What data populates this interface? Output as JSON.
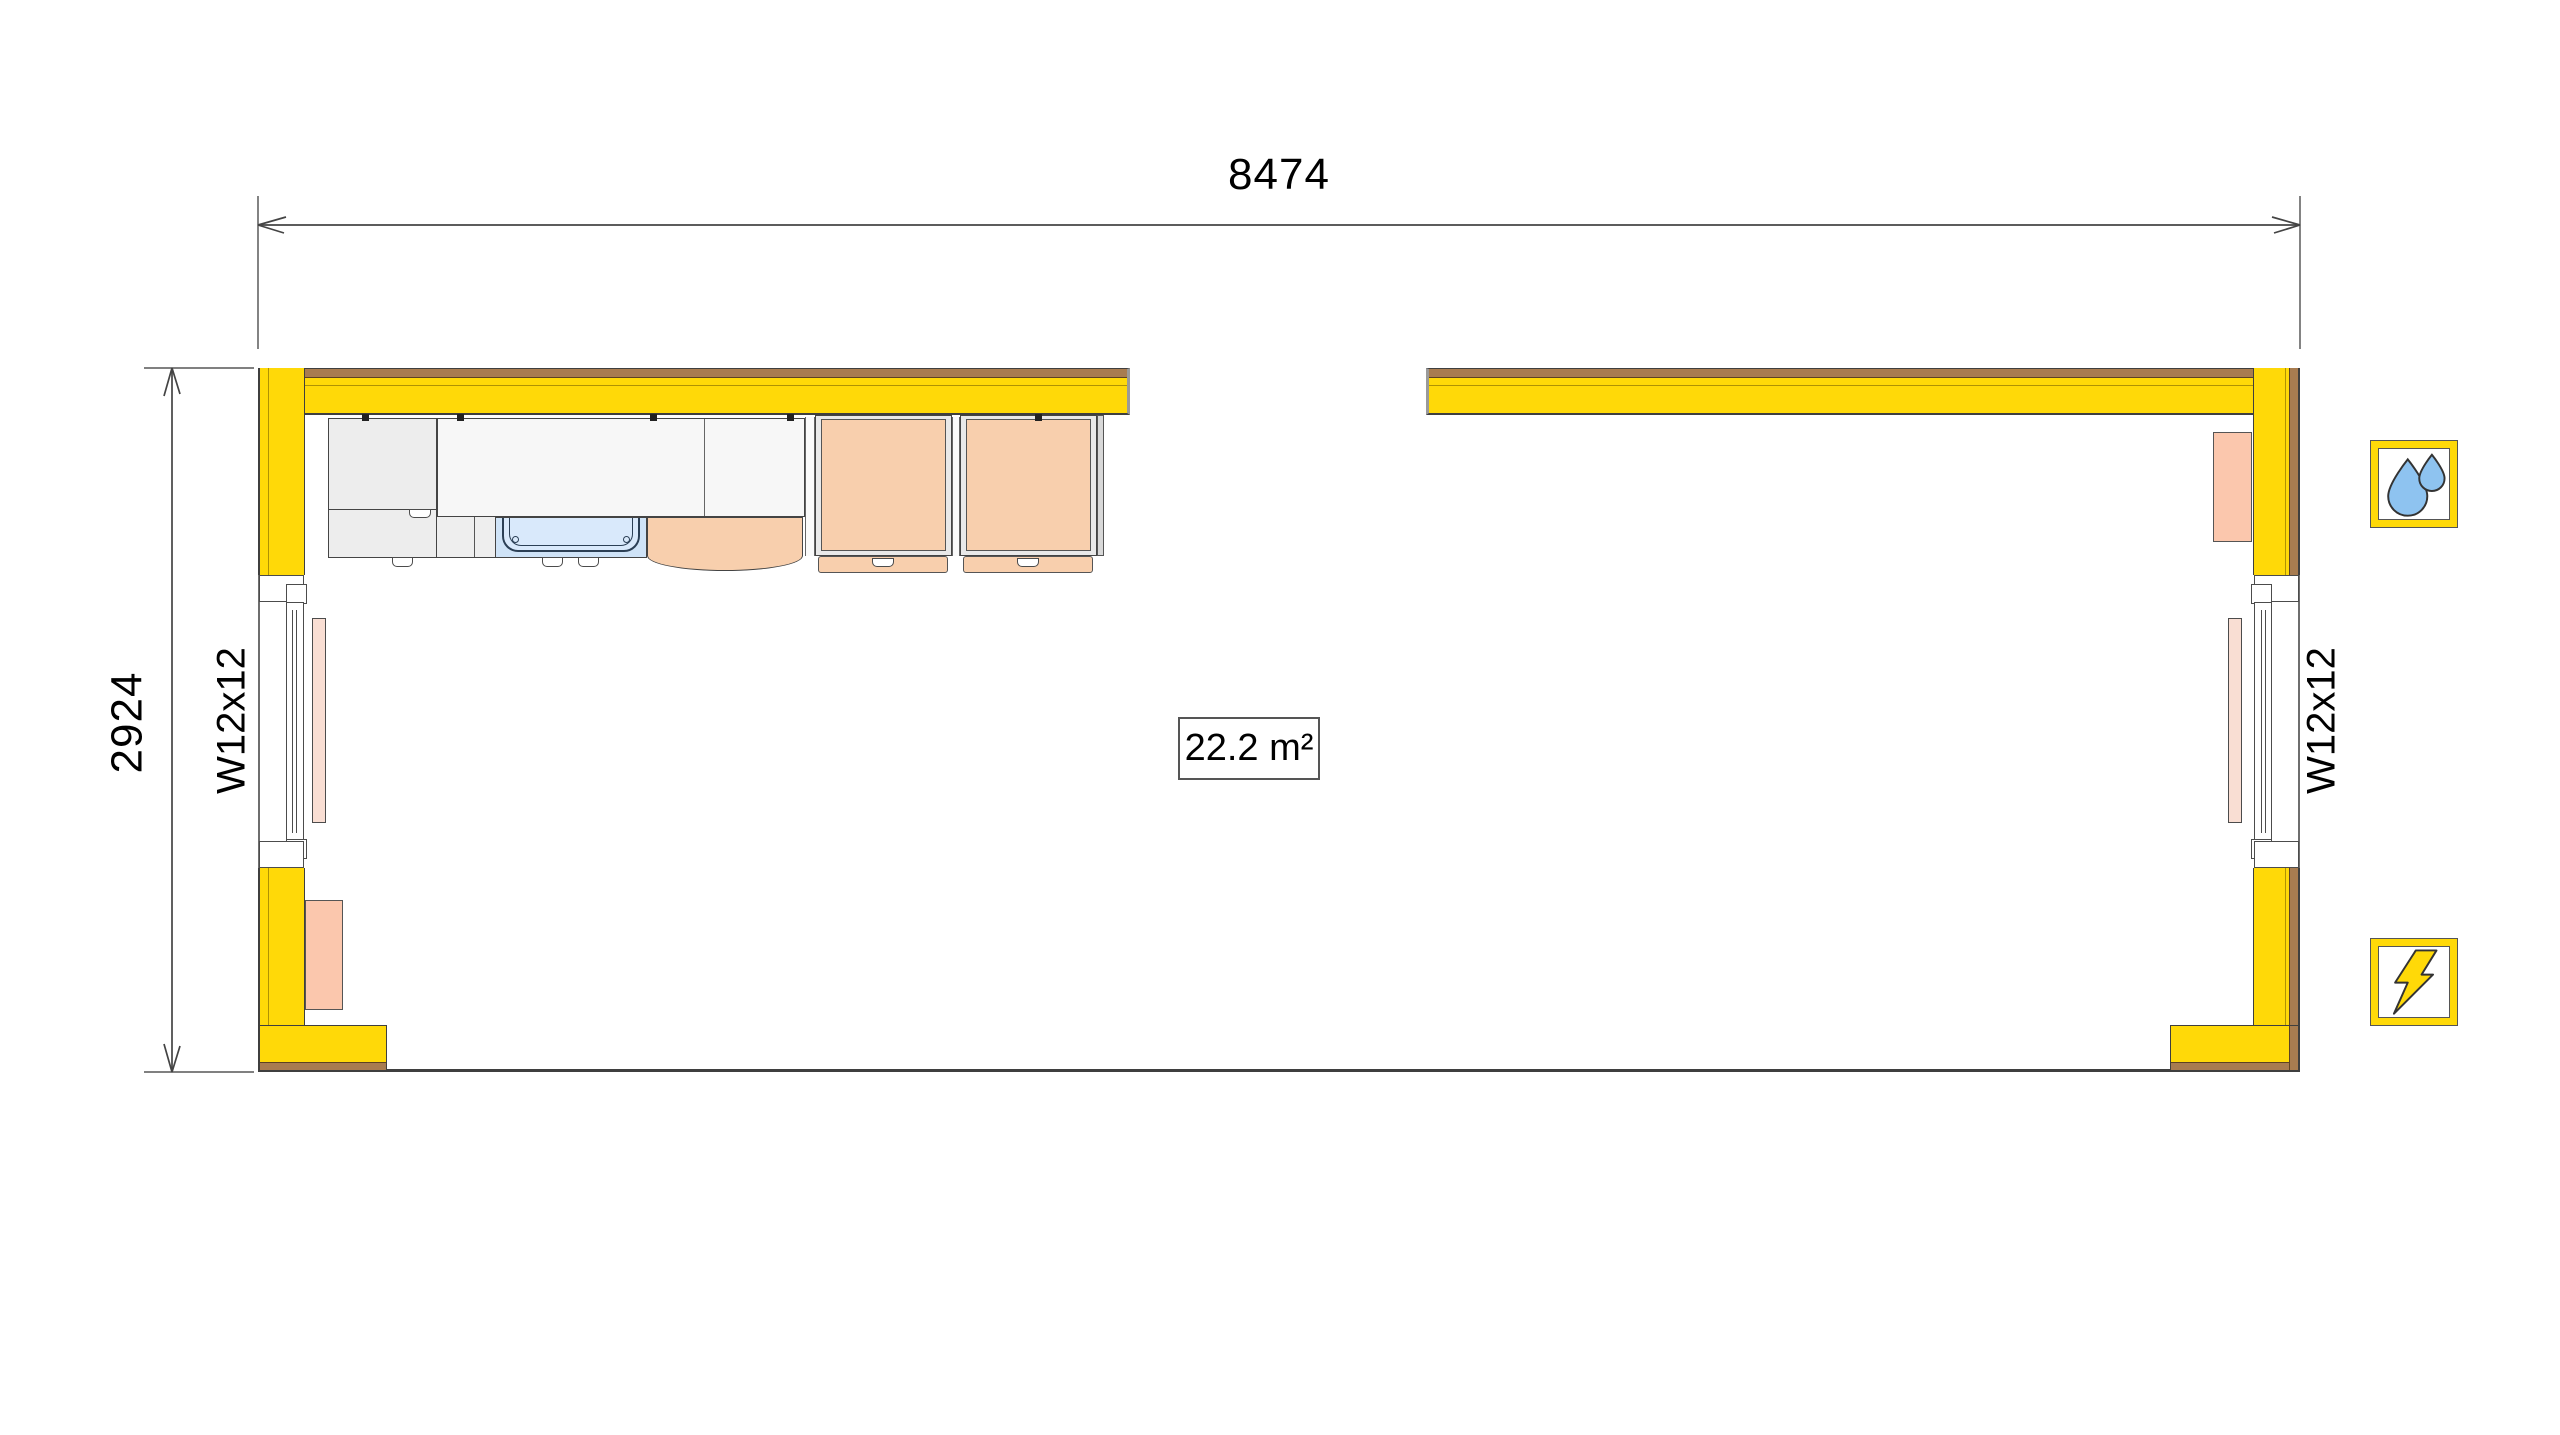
{
  "dimensions": {
    "width": "8474",
    "height": "2924"
  },
  "windows": {
    "left_label": "W12x12",
    "right_label": "W12x12"
  },
  "room": {
    "area": "22.2 m²"
  },
  "icons": {
    "plumbing": "water-drops",
    "electrical": "lightning-bolt"
  },
  "colors": {
    "wall_yellow": "#FFD908",
    "trim_brown": "#A87C50",
    "cabinet_peach": "#F8CFAD",
    "radiator_salmon": "#FBC7AD",
    "sill_pink": "#F9DED3",
    "sink_blue": "#CFE3F7",
    "water_drop_blue": "#8EC3F0",
    "outline": "#3F3F3F"
  }
}
